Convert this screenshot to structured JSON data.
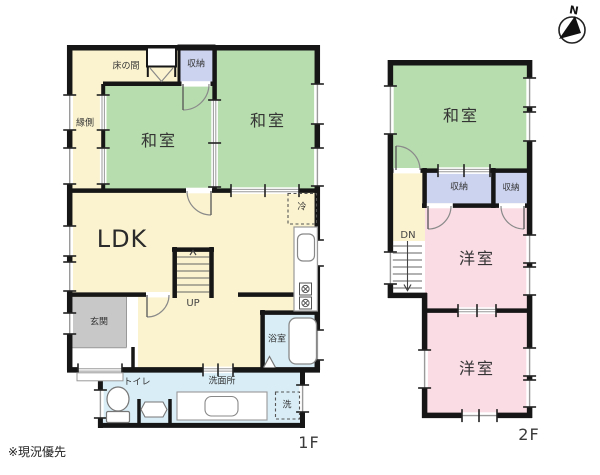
{
  "note": "※現況優先",
  "compass": {
    "north": "N"
  },
  "floor1": {
    "floor_label": "1F",
    "rooms": {
      "engawa": "縁側",
      "tokonoma": "床の間",
      "storage": "収納",
      "washitsu_left": "和室",
      "washitsu_right": "和室",
      "ldk": "LDK",
      "fridge": "冷",
      "genkan": "玄関",
      "stairs_up": "UP",
      "bath": "浴室",
      "toilet": "トイレ",
      "washroom": "洗面所",
      "washer": "洗"
    }
  },
  "floor2": {
    "floor_label": "2F",
    "rooms": {
      "washitsu": "和室",
      "storage_left": "収納",
      "storage_right": "収納",
      "stairs_down": "DN",
      "youshitsu_top": "洋室",
      "youshitsu_bottom": "洋室"
    }
  },
  "colors": {
    "tatami_green": "#b7dcae",
    "western_pink": "#f9dce4",
    "wood_cream": "#fbf3cf",
    "storage_lavender": "#ccd3ee",
    "wet_area_blue": "#d8edf6",
    "entry_gray": "#c8c8c8",
    "wall": "#161616"
  }
}
